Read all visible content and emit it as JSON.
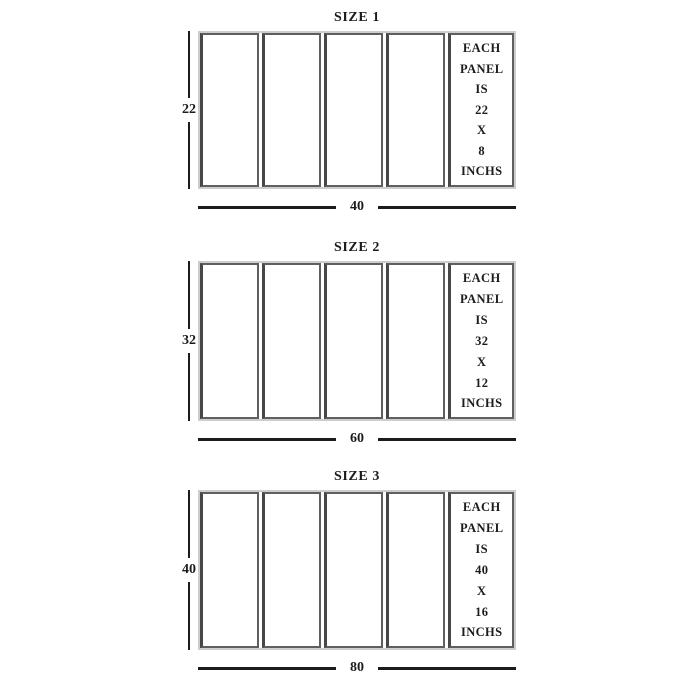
{
  "colors": {
    "background": "#ffffff",
    "ink": "#1c1c1c",
    "panel_border": "#5f5f5f",
    "panel_border_dark": "#474747",
    "outer_border": "#cdcdcd"
  },
  "diagrams": [
    {
      "title": "SIZE 1",
      "height_label": "22",
      "width_label": "40",
      "panel_lines": [
        "EACH",
        "PANEL",
        "IS",
        "22",
        "X",
        "8",
        "INCHS"
      ]
    },
    {
      "title": "SIZE 2",
      "height_label": "32",
      "width_label": "60",
      "panel_lines": [
        "EACH",
        "PANEL",
        "IS",
        "32",
        "X",
        "12",
        "INCHS"
      ]
    },
    {
      "title": "SIZE 3",
      "height_label": "40",
      "width_label": "80",
      "panel_lines": [
        "EACH",
        "PANEL",
        "IS",
        "40",
        "X",
        "16",
        "INCHS"
      ]
    }
  ]
}
